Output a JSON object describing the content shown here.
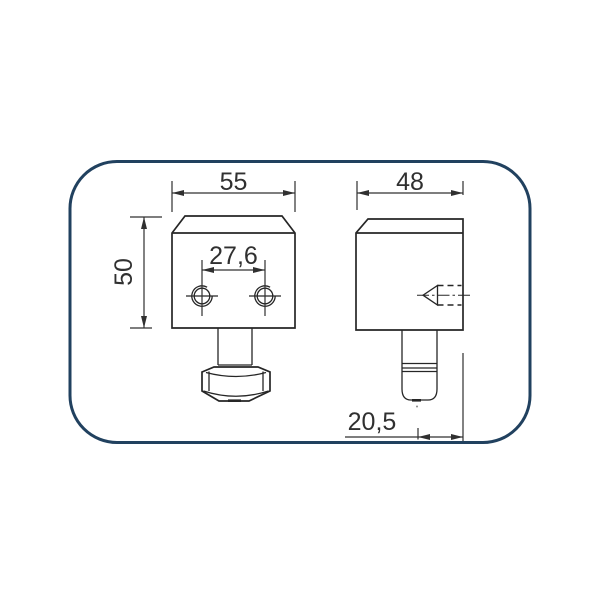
{
  "drawing": {
    "frame_color": "#21415f",
    "line_color": "#262626",
    "dim_color": "#303030",
    "dimensions": {
      "front_width": "55",
      "front_height": "50",
      "hole_spacing": "27,6",
      "side_width": "48",
      "pin_offset": "20,5"
    }
  }
}
